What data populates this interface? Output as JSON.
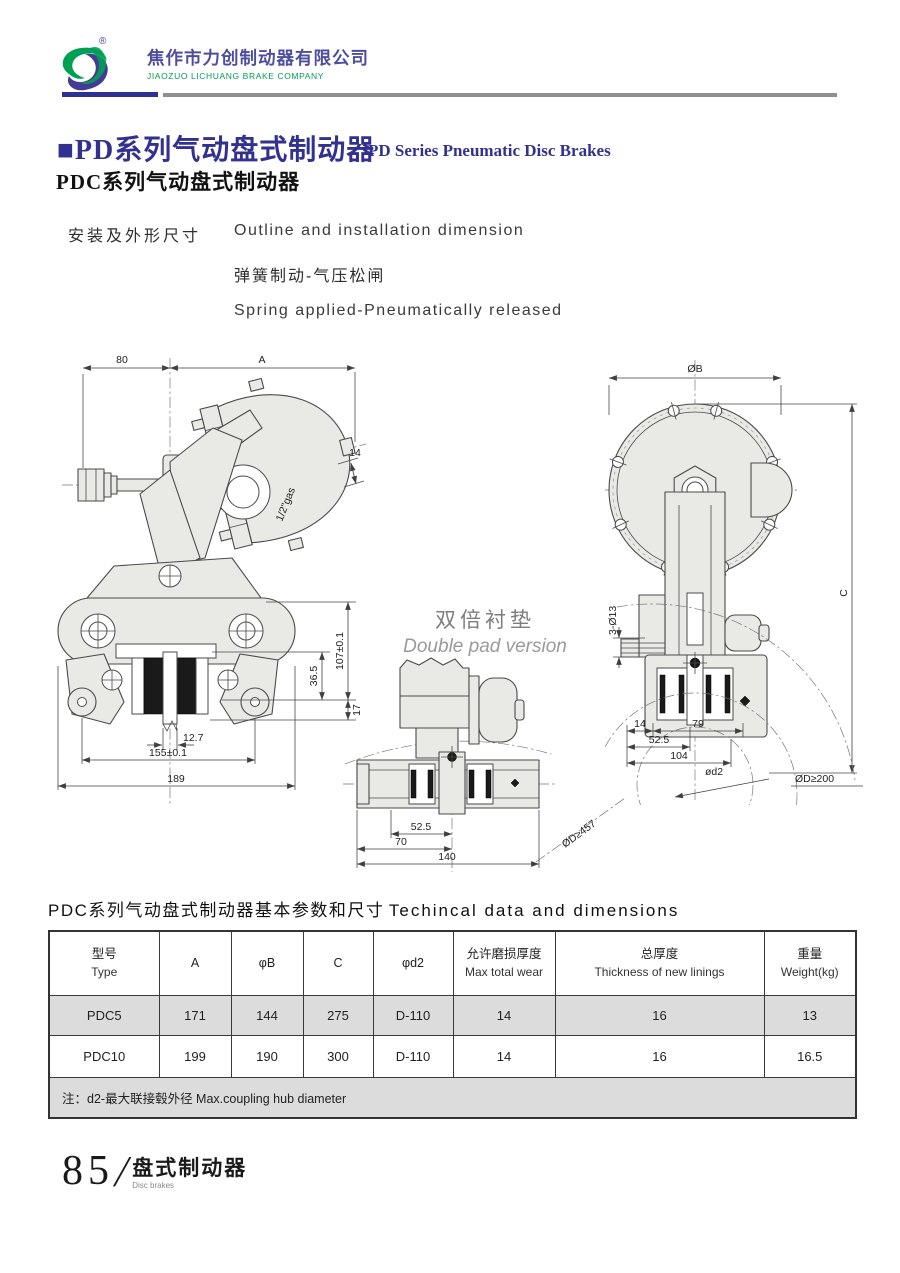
{
  "header": {
    "company_cn": "焦作市力创制动器有限公司",
    "company_en": "JIAOZUO LICHUANG BRAKE COMPANY",
    "reg": "®"
  },
  "title": {
    "cn": "■PD系列气动盘式制动器",
    "en": "PD Series Pneumatic Disc Brakes",
    "sub": "PDC系列气动盘式制动器"
  },
  "intro": {
    "cn_label": "安装及外形尺寸",
    "en_label": "Outline and installation dimension",
    "line2_cn": "弹簧制动-气压松闸",
    "line2_en": "Spring applied-Pneumatically released"
  },
  "drawings": {
    "front": {
      "d80": "80",
      "dA": "A",
      "d14": "14",
      "gas": "1/2\"gas",
      "h107": "107±0.1",
      "h36": "36.5",
      "h17": "17",
      "w127": "12.7",
      "w155": "155±0.1",
      "w189": "189"
    },
    "double_pad": {
      "title_cn": "双倍衬垫",
      "title_en": "Double pad version",
      "d52": "52.5",
      "d70": "70",
      "d140": "140",
      "disc": "ØD≥457"
    },
    "side": {
      "dB": "ØB",
      "dC": "C",
      "holes": "3-Ø13",
      "d14": "14",
      "d79": "79",
      "d52": "52.5",
      "d104": "104",
      "hub": "ød2",
      "disc": "ØD≥200"
    }
  },
  "table": {
    "title_cn": "PDC系列气动盘式制动器基本参数和尺寸",
    "title_en": "Techincal data and dimensions",
    "headers": [
      {
        "cn": "型号",
        "en": "Type"
      },
      {
        "cn": "A",
        "en": ""
      },
      {
        "cn": "φB",
        "en": ""
      },
      {
        "cn": "C",
        "en": ""
      },
      {
        "cn": "φd2",
        "en": ""
      },
      {
        "cn": "允许磨损厚度",
        "en": "Max total wear"
      },
      {
        "cn": "总厚度",
        "en": "Thickness of new linings"
      },
      {
        "cn": "重量",
        "en": "Weight(kg)"
      }
    ],
    "rows": [
      [
        "PDC5",
        "171",
        "144",
        "275",
        "D-110",
        "14",
        "16",
        "13"
      ],
      [
        "PDC10",
        "199",
        "190",
        "300",
        "D-110",
        "14",
        "16",
        "16.5"
      ]
    ],
    "note": "注：d2-最大联接毂外径  Max.coupling hub diameter"
  },
  "footer": {
    "page": "85",
    "cn": "盘式制动器",
    "en": "Disc brakes"
  },
  "colors": {
    "accent_purple": "#2e3192",
    "brand_green": "#00a054",
    "divider_gray": "#8f8f8f",
    "row_gray": "#dcdcdc"
  }
}
